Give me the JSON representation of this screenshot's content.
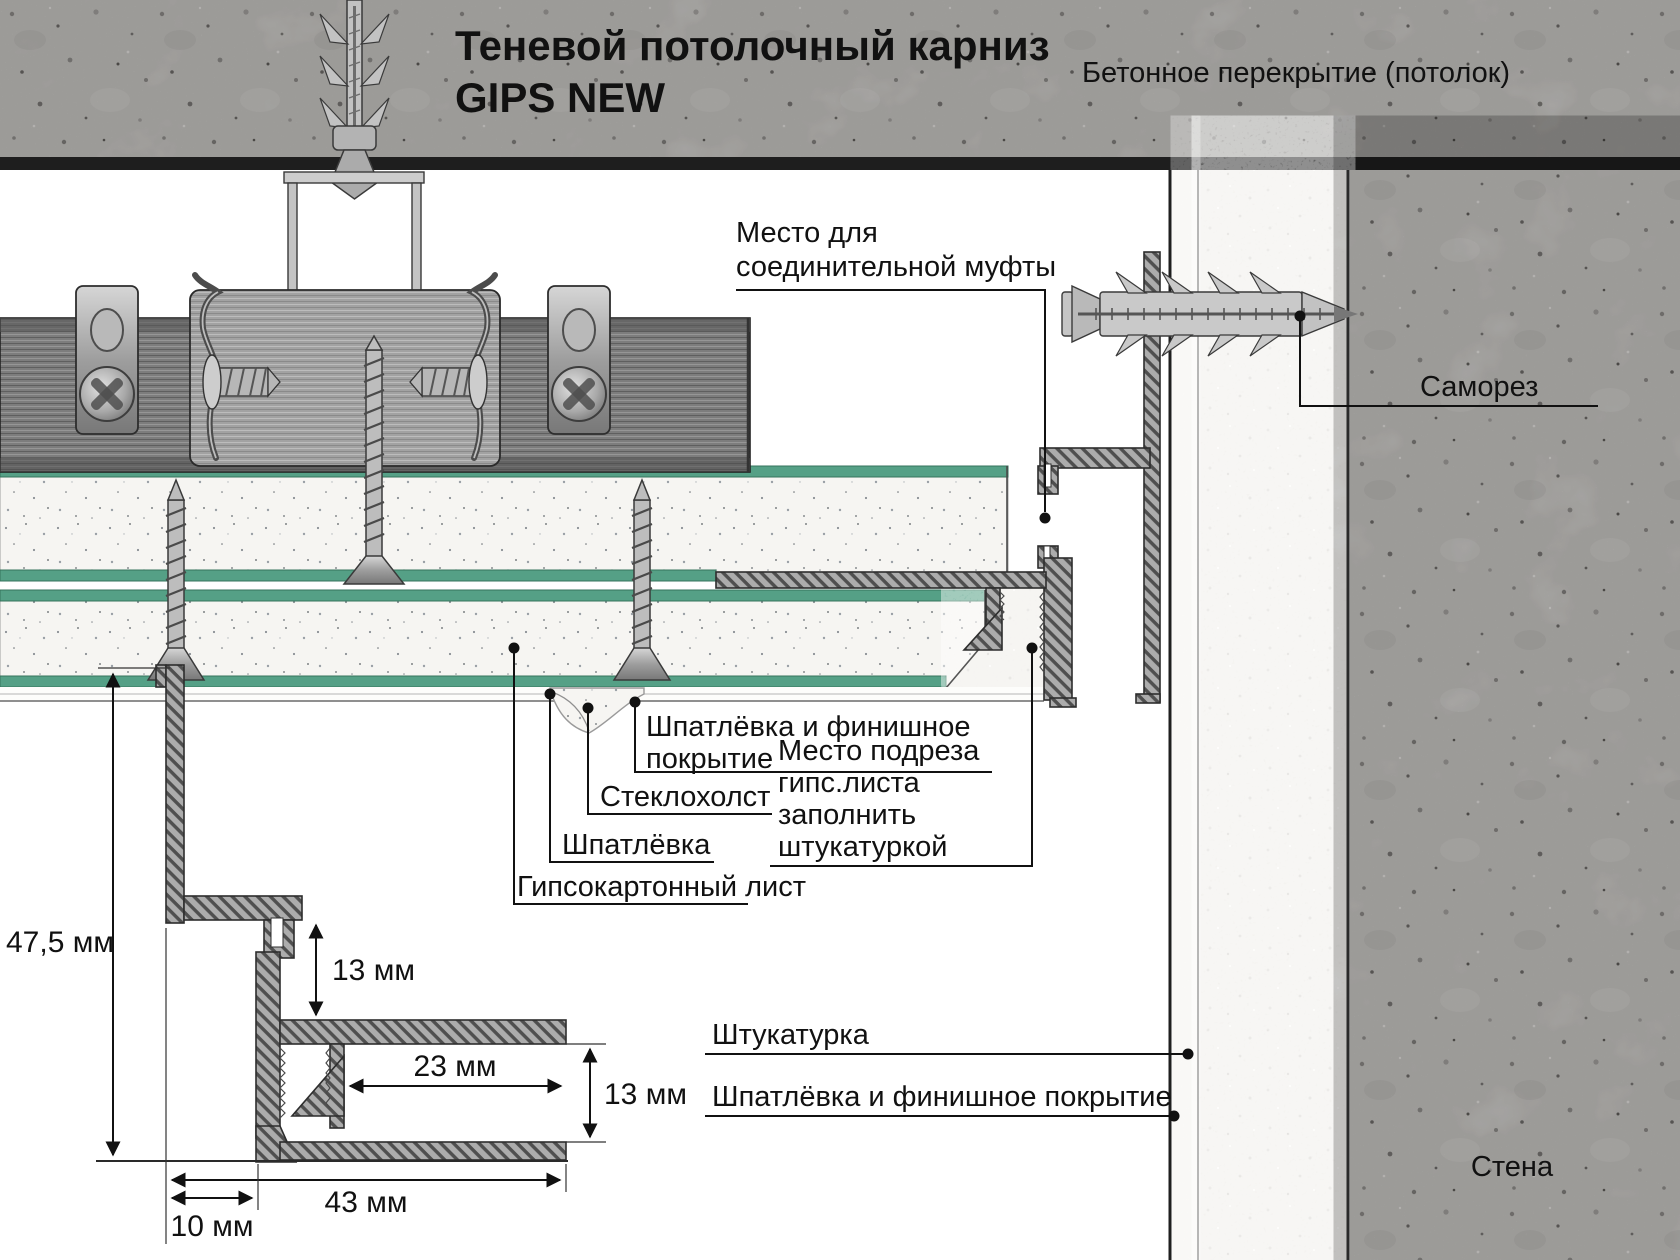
{
  "title": {
    "line1": "Теневой потолочный карниз",
    "line2": "GIPS NEW"
  },
  "top_labels": {
    "ceiling": "Бетонное перекрытие (потолок)"
  },
  "callouts": {
    "mufta": {
      "line1": "Место для",
      "line2": "соединительной муфты"
    },
    "samorez": "Саморез",
    "finish_top": {
      "line1": "Шпатлёвка и финишное",
      "line2": "покрытие"
    },
    "steklokholst": "Стеклохолст",
    "shpatlevka": "Шпатлёвка",
    "gkl": "Гипсокартонный лист",
    "podrez": {
      "line1": "Место подреза",
      "line2": "гипс.листа",
      "line3": "заполнить",
      "line4": "штукатуркой"
    },
    "shtukaturka": "Штукатурка",
    "finish_bottom": "Шпатлёвка и финишное покрытие",
    "wall": "Стена"
  },
  "dimensions": {
    "total_height": "47,5 мм",
    "top_channel": "13 мм",
    "flange_overhang": "23 мм",
    "bottom_channel": "13 мм",
    "total_width": "43 мм",
    "shadow_gap": "10 мм"
  },
  "colors": {
    "drywall_face_green": "#55a086",
    "callout_line": "#111111",
    "concrete_base": "#c9c7c4",
    "plaster_base": "#efede9",
    "metal_profile": "#7a7a7a",
    "hatch_fill": "#acacac"
  }
}
